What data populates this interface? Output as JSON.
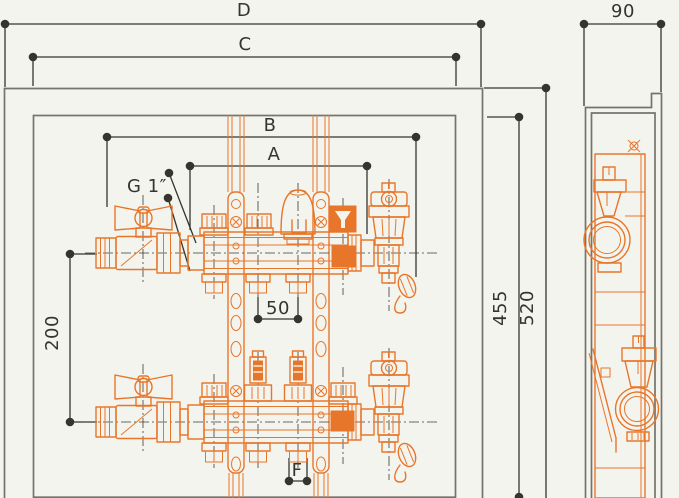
{
  "drawing": {
    "labels": {
      "overall_width": "D",
      "opening_width": "C",
      "manifold_length": "B",
      "connection_span": "A",
      "main_connection": "G 1″",
      "row_spacing": "200",
      "outlet_pitch": "50",
      "pipe_pair": "F",
      "opening_height": "455",
      "overall_height": "520",
      "depth": "90"
    }
  },
  "colors": {
    "component": "#e8762a",
    "dimension": "#35352f",
    "frame": "#74746e",
    "background": "#f4f4ee"
  }
}
